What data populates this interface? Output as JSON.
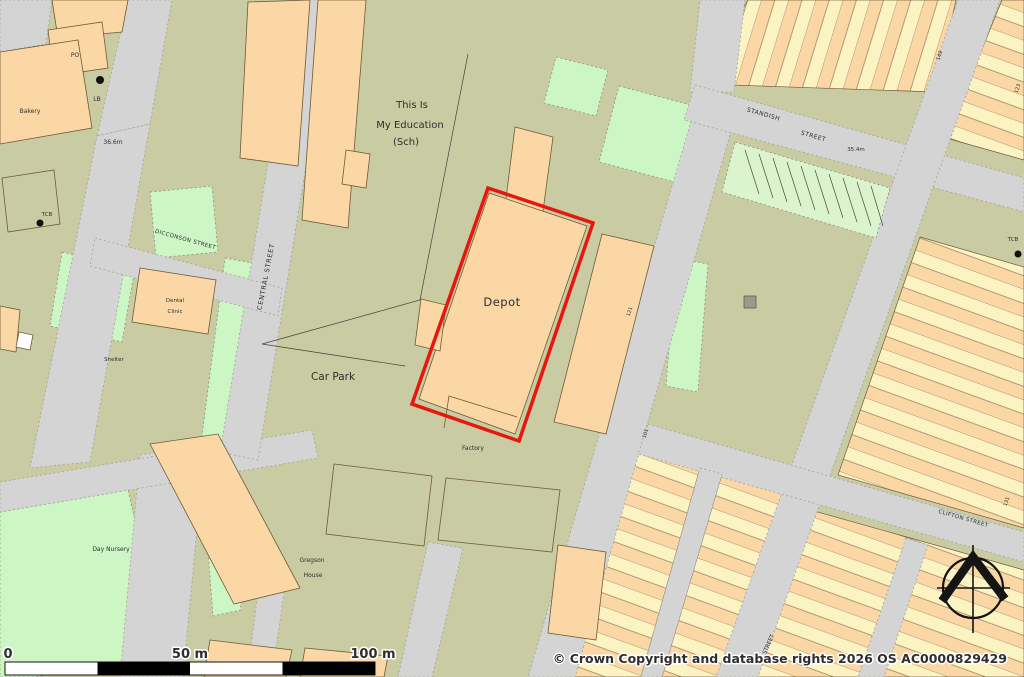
{
  "map": {
    "buildings": {
      "school": [
        "This Is",
        "My Education",
        "(Sch)"
      ],
      "depot": "Depot",
      "car_park": "Car Park",
      "factory": "Factory",
      "bakery": "Bakery",
      "post_office": "PO",
      "letter_box": "LB",
      "dental_clinic": [
        "Dental",
        "Clinic"
      ],
      "shelter": "Shelter",
      "day_nursery": "Day Nursery",
      "gregson_house": [
        "Gregson",
        "House"
      ],
      "tcb_west": "TCB",
      "tcb_east": "TCB"
    },
    "streets": {
      "dicconson": "DICCONSON STREET",
      "central": "CENTRAL STREET",
      "standish_word1": "STANDISH",
      "standish_word2": "STREET",
      "clifton": "CLIFTON STREET",
      "unnamed": "STREET"
    },
    "spot_heights": {
      "west": "36.6m",
      "east": "35.4m"
    },
    "house_numbers": {
      "a": "121",
      "b": "149",
      "c": "123",
      "d": "101",
      "e": "131"
    }
  },
  "scale_bar": {
    "t0": "0",
    "t50": "50 m",
    "t100": "100 m"
  },
  "attribution": "© Crown Copyright and database rights 2026 OS AC0000829429",
  "colors": {
    "highlight": "#e8170d",
    "road": "#d4d4d4",
    "block": "#c9cba2",
    "building": "#fbd7a6",
    "green": "#cdf6c5"
  }
}
